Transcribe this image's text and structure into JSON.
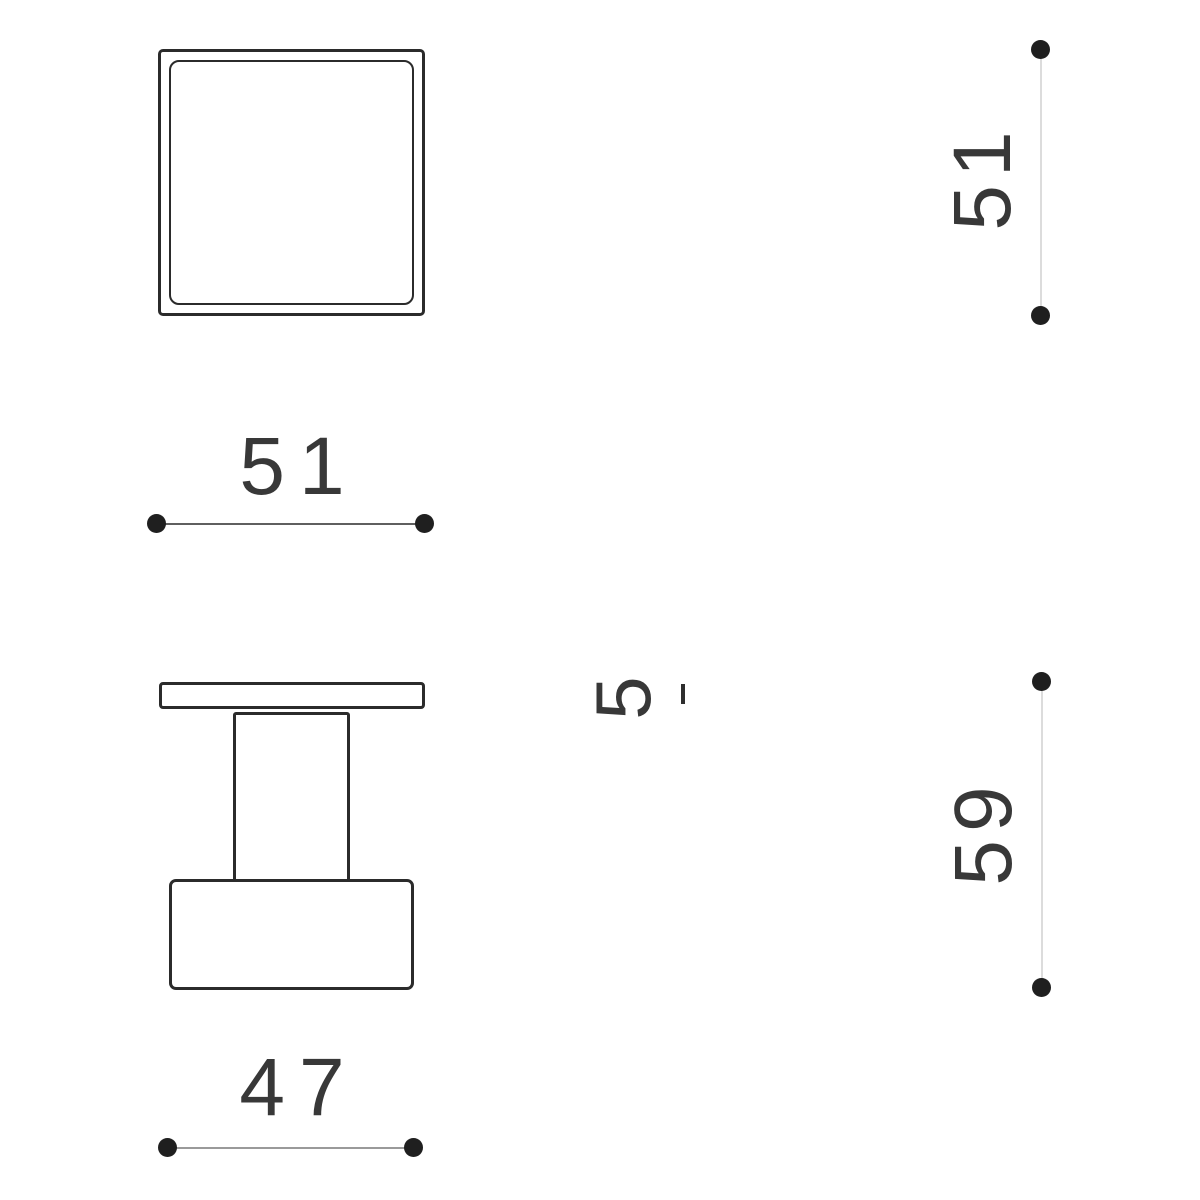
{
  "diagram": {
    "type": "technical-dimension-drawing",
    "background_color": "#ffffff",
    "outline_color": "#2b2b2b",
    "text_color": "#383838",
    "dot_color": "#1f1f1f",
    "dim_line_colors": {
      "vertical_light": "#dcdcdc",
      "horizontal_mid": "#5f5f5f",
      "horizontal_bottom": "#9a9a9a"
    },
    "views": {
      "front": "square face with inner square inset",
      "side": "T-profile: top flange, stem, base block"
    },
    "dimensions": {
      "front_width": {
        "value": "51",
        "orientation": "horizontal"
      },
      "front_height": {
        "value": "51",
        "orientation": "vertical"
      },
      "side_width": {
        "value": "47",
        "orientation": "horizontal"
      },
      "side_height": {
        "value": "59",
        "orientation": "vertical"
      },
      "partial": {
        "value": "5",
        "orientation": "vertical",
        "note": "clipped label fragment"
      }
    }
  }
}
